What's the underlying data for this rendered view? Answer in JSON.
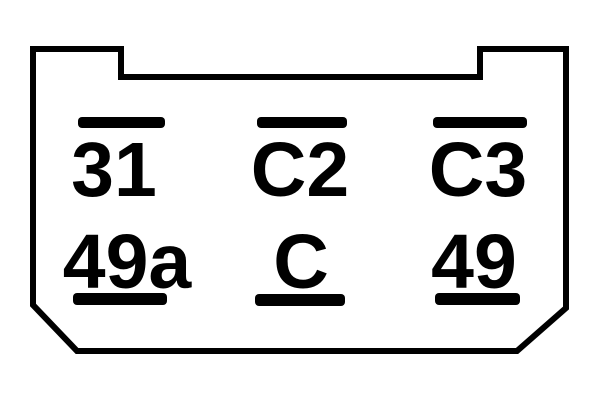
{
  "diagram": {
    "type": "relay-socket-pinout",
    "background_color": "#ffffff",
    "line_color": "#000000",
    "terminals": [
      {
        "label": "31",
        "row": "top",
        "column": "left"
      },
      {
        "label": "C2",
        "row": "top",
        "column": "center"
      },
      {
        "label": "C3",
        "row": "top",
        "column": "right"
      },
      {
        "label": "49a",
        "row": "bottom",
        "column": "left"
      },
      {
        "label": "C",
        "row": "bottom",
        "column": "center"
      },
      {
        "label": "49",
        "row": "bottom",
        "column": "right"
      }
    ]
  }
}
